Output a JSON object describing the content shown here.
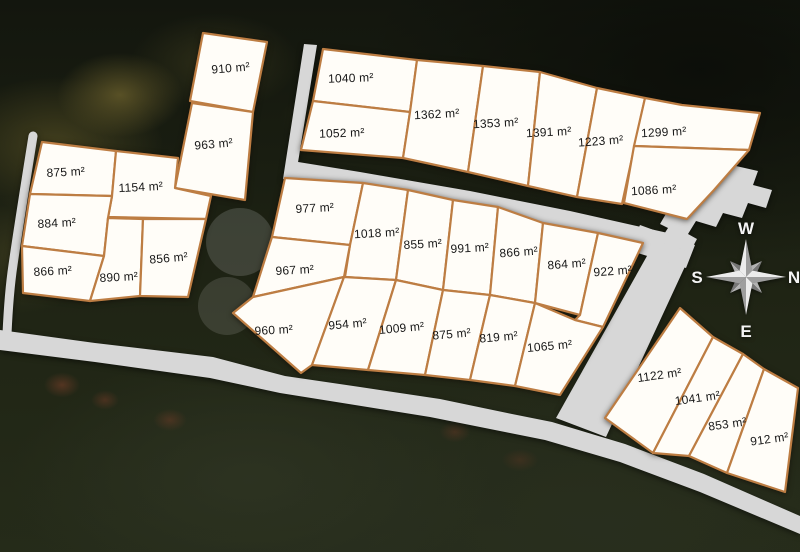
{
  "map": {
    "unit_suffix": "m²",
    "colors": {
      "plot_fill": "#fffdf8",
      "plot_border": "#bd7d43",
      "road": "#d7d7d7",
      "label_text": "#181818",
      "compass_text": "#f4f4f4"
    },
    "compass": {
      "top": "W",
      "left": "S",
      "right": "N",
      "bottom": "E"
    },
    "plots": [
      {
        "id": "plot-910",
        "area": 910,
        "label": "910 m²"
      },
      {
        "id": "plot-963",
        "area": 963,
        "label": "963 m²"
      },
      {
        "id": "plot-875-left",
        "area": 875,
        "label": "875 m²"
      },
      {
        "id": "plot-1154",
        "area": 1154,
        "label": "1154 m²"
      },
      {
        "id": "plot-884",
        "area": 884,
        "label": "884 m²"
      },
      {
        "id": "plot-866-left",
        "area": 866,
        "label": "866 m²"
      },
      {
        "id": "plot-890",
        "area": 890,
        "label": "890 m²"
      },
      {
        "id": "plot-856",
        "area": 856,
        "label": "856 m²"
      },
      {
        "id": "plot-1040",
        "area": 1040,
        "label": "1040 m²"
      },
      {
        "id": "plot-1052",
        "area": 1052,
        "label": "1052 m²"
      },
      {
        "id": "plot-1362",
        "area": 1362,
        "label": "1362 m²"
      },
      {
        "id": "plot-1353",
        "area": 1353,
        "label": "1353 m²"
      },
      {
        "id": "plot-1391",
        "area": 1391,
        "label": "1391 m²"
      },
      {
        "id": "plot-1223",
        "area": 1223,
        "label": "1223 m²"
      },
      {
        "id": "plot-1299",
        "area": 1299,
        "label": "1299 m²"
      },
      {
        "id": "plot-1086",
        "area": 1086,
        "label": "1086 m²"
      },
      {
        "id": "plot-977",
        "area": 977,
        "label": "977 m²"
      },
      {
        "id": "plot-1018",
        "area": 1018,
        "label": "1018 m²"
      },
      {
        "id": "plot-855",
        "area": 855,
        "label": "855 m²"
      },
      {
        "id": "plot-991",
        "area": 991,
        "label": "991 m²"
      },
      {
        "id": "plot-866-mid",
        "area": 866,
        "label": "866 m²"
      },
      {
        "id": "plot-864",
        "area": 864,
        "label": "864 m²"
      },
      {
        "id": "plot-922",
        "area": 922,
        "label": "922 m²"
      },
      {
        "id": "plot-967",
        "area": 967,
        "label": "967 m²"
      },
      {
        "id": "plot-960",
        "area": 960,
        "label": "960 m²"
      },
      {
        "id": "plot-954",
        "area": 954,
        "label": "954 m²"
      },
      {
        "id": "plot-1009",
        "area": 1009,
        "label": "1009 m²"
      },
      {
        "id": "plot-875-mid",
        "area": 875,
        "label": "875 m²"
      },
      {
        "id": "plot-819",
        "area": 819,
        "label": "819 m²"
      },
      {
        "id": "plot-1065",
        "area": 1065,
        "label": "1065 m²"
      },
      {
        "id": "plot-1122",
        "area": 1122,
        "label": "1122 m²"
      },
      {
        "id": "plot-1041",
        "area": 1041,
        "label": "1041 m²"
      },
      {
        "id": "plot-853",
        "area": 853,
        "label": "853 m²"
      },
      {
        "id": "plot-912",
        "area": 912,
        "label": "912 m²"
      }
    ]
  }
}
